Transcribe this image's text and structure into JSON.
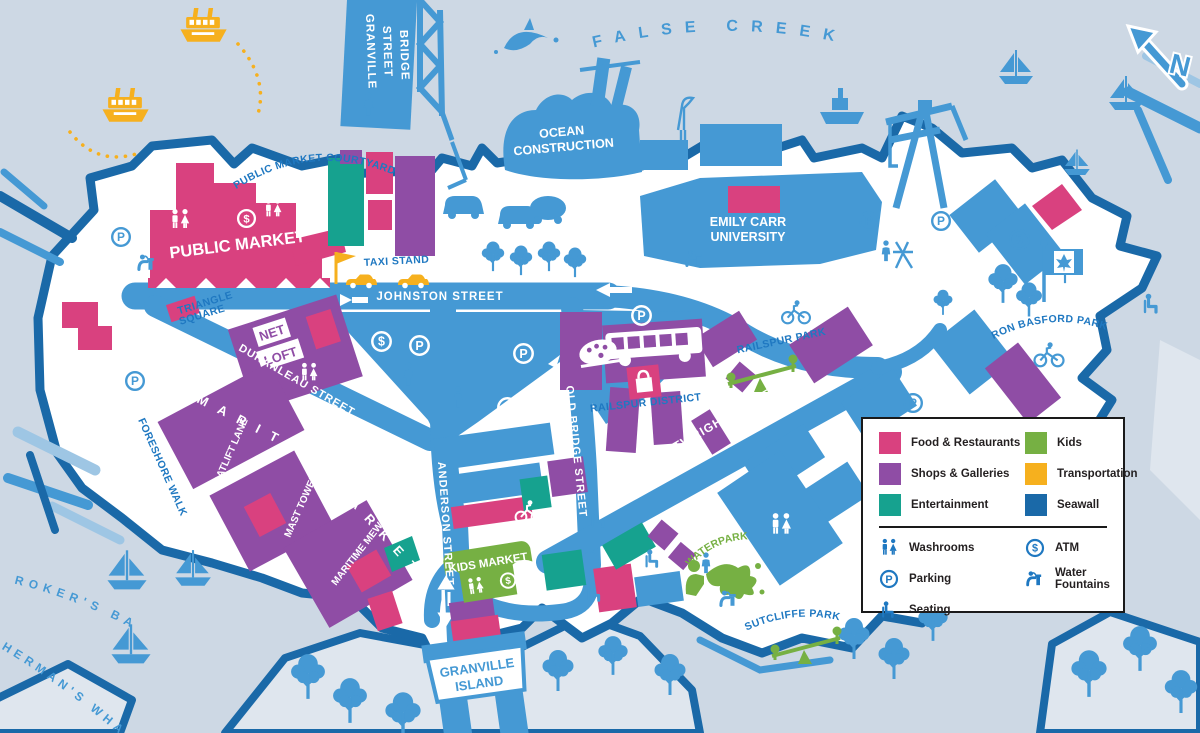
{
  "title": "Granville Island illustrated visitor map",
  "colors": {
    "water": "#cdd8e4",
    "land": "#ffffff",
    "shore": "#dfe6ee",
    "road_blue": "#4599d4",
    "light_blue": "#9ec6e4",
    "label_blue": "#1f78c1",
    "food": "#d9417f",
    "shops": "#8f4da5",
    "entertainment": "#16a28f",
    "kids": "#76b043",
    "transportation": "#f6b01e",
    "seawall": "#1a69a8"
  },
  "labels": {
    "false_creek": "FALSE CREEK",
    "bridge": [
      "GRANVILLE",
      "STREET",
      "BRIDGE"
    ],
    "ocean_construction": [
      "OCEAN",
      "CONSTRUCTION"
    ],
    "emily_carr": [
      "EMILY CARR",
      "UNIVERSITY"
    ],
    "public_market_courtyard": "PUBLIC MARKET COURTYARD",
    "public_market": "PUBLIC MARKET",
    "taxi_stand": "TAXI STAND",
    "triangle_square": [
      "TRIANGLE",
      "SQUARE"
    ],
    "johnston_street": "JOHNSTON STREET",
    "net_loft": [
      "NET",
      "LOFT"
    ],
    "duranleau_street": "DURANLEAU STREET",
    "foreshore_walk": "FORESHORE WALK",
    "boatlift_lane": "BOATLIFT LANE",
    "mast_tower_road": "MAST TOWER ROAD",
    "maritime_mews": "MARITIME MEWS",
    "maritime": "MARITIME",
    "market": "MARKET",
    "anderson_street": "ANDERSON STREET",
    "old_bridge_street": "OLD BRIDGE STREET",
    "cartwright_street": "CARTWRIGHT STREET",
    "railspur_district": "RAILSPUR DISTRICT",
    "railspur_park": "RAILSPUR PARK",
    "ron_basford_park": "RON BASFORD PARK",
    "waterpark": "WATERPARK",
    "sutcliffe_park": "SUTCLIFFE PARK",
    "kids_market": "KIDS MARKET",
    "granville_island": [
      "GRANVILLE",
      "ISLAND"
    ],
    "brokers_bay": "BROKER'S BAY",
    "fishermans_wharf": "FISHERMAN'S WHARF",
    "compass": "N"
  },
  "icons": {
    "parking_glyph": "P",
    "atm_glyph": "$"
  },
  "legend": {
    "categories": [
      {
        "label": "Food & Restaurants",
        "color": "#d9417f"
      },
      {
        "label": "Kids",
        "color": "#76b043"
      },
      {
        "label": "Shops & Galleries",
        "color": "#8f4da5"
      },
      {
        "label": "Transportation",
        "color": "#f6b01e"
      },
      {
        "label": "Entertainment",
        "color": "#16a28f"
      },
      {
        "label": "Seawall",
        "color": "#1a69a8"
      }
    ],
    "facilities": [
      {
        "label": "Washrooms",
        "icon": "washrooms-icon"
      },
      {
        "label": "ATM",
        "icon": "atm-icon"
      },
      {
        "label": "Parking",
        "icon": "parking-icon"
      },
      {
        "label": "Water Fountains",
        "icon": "water-fountain-icon"
      },
      {
        "label": "Seating",
        "icon": "seating-icon"
      }
    ]
  }
}
